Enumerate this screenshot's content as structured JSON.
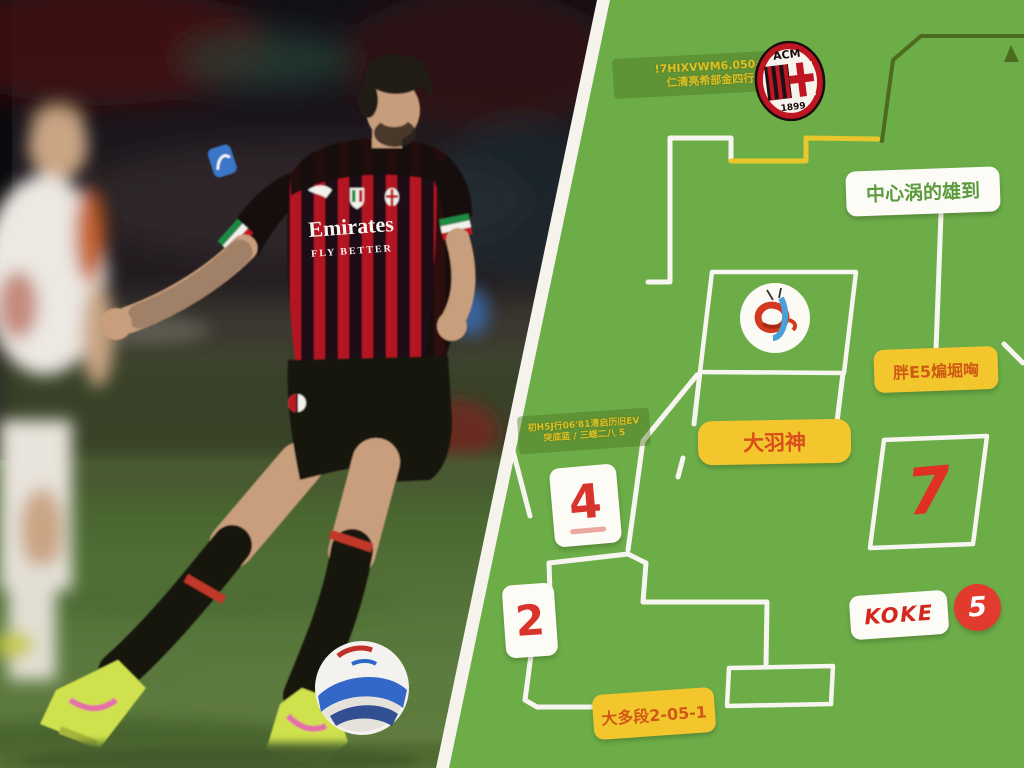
{
  "meta": {
    "description": "Football news thumbnail: AC Milan player photo on the left, green tactics/transfer infographic panel on the right",
    "colors": {
      "panel_green": "#6dad48",
      "line_white": "#f7f5ef",
      "path_yellow": "#e8c62c",
      "path_olive": "#4c6b1f",
      "box_yellow": "#f3c62e",
      "accent_red": "#dd3227",
      "label_green_text": "#5c9a3e",
      "label_orange_text": "#cf5a14"
    }
  },
  "photo": {
    "sponsor_line1": "Emirates",
    "sponsor_line2": "FLY BETTER",
    "team": "AC Milan home kit (red/black stripes)"
  },
  "milan_crest": {
    "top_text": "ACM",
    "bottom_text": "1899"
  },
  "panel": {
    "top_label": {
      "line1": "!7HIXVWM6.050#",
      "line2": "仁清亮希部金四行"
    },
    "center_label": {
      "text": "中心涡的雄到"
    },
    "right_yellow_label": {
      "text": "胖E5煸堀哅"
    },
    "player_label": {
      "text": "大羽神"
    },
    "mid_label": {
      "line1": "初H5J行06'81清启历旧EV",
      "line2": "突底蓝 / 三嵯二八 5"
    },
    "bottom_label": {
      "text": "大多段2-05-1"
    },
    "box4": {
      "value": "4"
    },
    "box2": {
      "value": "2"
    },
    "box7": {
      "value": "7"
    },
    "pill": {
      "text": "KOKE"
    },
    "badge5": {
      "value": "5"
    }
  },
  "icons": {
    "milan_crest": "ac-milan-crest-icon",
    "koln_crest": "club-crest-circle-icon",
    "triangle": "triangle-marker-icon",
    "ball": "serie-a-match-ball",
    "puma": "puma-logo-icon",
    "scudetto": "scudetto-badge-icon",
    "patch": "serie-a-sleeve-patch-icon"
  }
}
